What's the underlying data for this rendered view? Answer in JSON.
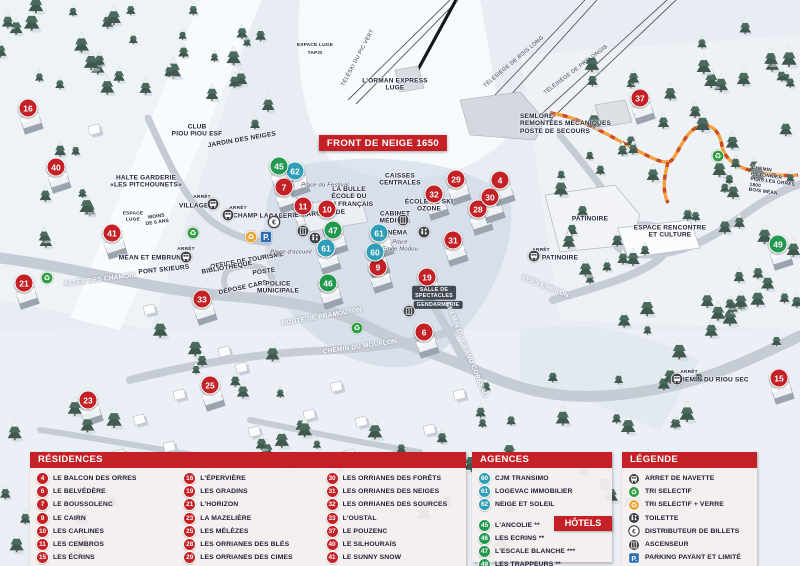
{
  "colors": {
    "red": "#c42126",
    "teal": "#2f9fb8",
    "green": "#23984f",
    "parking_blue": "#2a6db4",
    "legend_dark": "#3e4045",
    "recycle_green": "#2f9e41",
    "recycle_yellow": "#e9a63b",
    "panel_bg": "rgba(246,239,239,0.95)",
    "path_orange": "#f0a13f",
    "path_dash": "#cf4a24"
  },
  "map": {
    "banner": {
      "text": "FRONT DE NEIGE 1650",
      "x": 383,
      "y": 143
    },
    "markers": [
      {
        "n": "16",
        "t": "res",
        "x": 28,
        "y": 108
      },
      {
        "n": "40",
        "t": "res",
        "x": 56,
        "y": 167
      },
      {
        "n": "41",
        "t": "res",
        "x": 112,
        "y": 233
      },
      {
        "n": "21",
        "t": "res",
        "x": 24,
        "y": 283
      },
      {
        "n": "33",
        "t": "res",
        "x": 202,
        "y": 299
      },
      {
        "n": "23",
        "t": "res",
        "x": 88,
        "y": 400
      },
      {
        "n": "25",
        "t": "res",
        "x": 210,
        "y": 385
      },
      {
        "n": "7",
        "t": "res",
        "x": 284,
        "y": 187
      },
      {
        "n": "11",
        "t": "res",
        "x": 303,
        "y": 206
      },
      {
        "n": "10",
        "t": "res",
        "x": 327,
        "y": 209
      },
      {
        "n": "9",
        "t": "res",
        "x": 378,
        "y": 267
      },
      {
        "n": "6",
        "t": "res",
        "x": 424,
        "y": 332
      },
      {
        "n": "19",
        "t": "res",
        "x": 427,
        "y": 277
      },
      {
        "n": "29",
        "t": "res",
        "x": 456,
        "y": 179
      },
      {
        "n": "32",
        "t": "res",
        "x": 434,
        "y": 194
      },
      {
        "n": "28",
        "t": "res",
        "x": 478,
        "y": 209
      },
      {
        "n": "30",
        "t": "res",
        "x": 490,
        "y": 197
      },
      {
        "n": "4",
        "t": "res",
        "x": 500,
        "y": 180
      },
      {
        "n": "31",
        "t": "res",
        "x": 453,
        "y": 240
      },
      {
        "n": "37",
        "t": "res",
        "x": 640,
        "y": 98
      },
      {
        "n": "15",
        "t": "res",
        "x": 779,
        "y": 378
      },
      {
        "n": "60",
        "t": "agency",
        "x": 375,
        "y": 252
      },
      {
        "n": "61",
        "t": "agency",
        "x": 326,
        "y": 248
      },
      {
        "n": "61",
        "t": "agency",
        "x": 379,
        "y": 233
      },
      {
        "n": "62",
        "t": "agency",
        "x": 295,
        "y": 171
      },
      {
        "n": "45",
        "t": "hotel",
        "x": 279,
        "y": 166
      },
      {
        "n": "46",
        "t": "hotel",
        "x": 328,
        "y": 283
      },
      {
        "n": "47",
        "t": "hotel",
        "x": 333,
        "y": 230
      },
      {
        "n": "49",
        "t": "hotel",
        "x": 778,
        "y": 244
      }
    ],
    "icons": [
      {
        "k": "bus",
        "x": 213,
        "y": 204
      },
      {
        "k": "bus",
        "x": 228,
        "y": 215
      },
      {
        "k": "bus",
        "x": 186,
        "y": 257
      },
      {
        "k": "bus",
        "x": 534,
        "y": 256
      },
      {
        "k": "bus",
        "x": 677,
        "y": 379
      },
      {
        "k": "recycle",
        "x": 47,
        "y": 278
      },
      {
        "k": "recycle",
        "x": 193,
        "y": 233
      },
      {
        "k": "recycle",
        "x": 357,
        "y": 328
      },
      {
        "k": "recycle",
        "x": 718,
        "y": 156
      },
      {
        "k": "recycle-verre",
        "x": 251,
        "y": 237
      },
      {
        "k": "parking",
        "x": 266,
        "y": 237
      },
      {
        "k": "euro",
        "x": 274,
        "y": 222
      },
      {
        "k": "ascenseur",
        "x": 303,
        "y": 231
      },
      {
        "k": "ascenseur",
        "x": 403,
        "y": 220
      },
      {
        "k": "ascenseur",
        "x": 409,
        "y": 311
      },
      {
        "k": "toilette",
        "x": 315,
        "y": 238
      },
      {
        "k": "toilette",
        "x": 424,
        "y": 232
      }
    ],
    "labels": [
      {
        "text": "TÉLÉSKI DU PIC VERT",
        "x": 358,
        "y": 58,
        "s": "lift",
        "r": -62
      },
      {
        "text": "TÉLÉSIÈGE DE BOIS LONG",
        "x": 514,
        "y": 62,
        "s": "lift",
        "r": -40
      },
      {
        "text": "TÉLÉSIÈGE DE PRÉLONGIS",
        "x": 576,
        "y": 70,
        "s": "lift",
        "r": -37
      },
      {
        "text": "L'ORMAN EXPRESS\nLUGE",
        "x": 395,
        "y": 85,
        "s": "name"
      },
      {
        "text": "SEMLORE\nREMONTÉES MÉCANIQUES\nPOSTE DE SECOURS",
        "x": 520,
        "y": 124,
        "s": "name-left"
      },
      {
        "text": "ESPACE LUGE",
        "x": 315,
        "y": 46,
        "s": "tiny"
      },
      {
        "text": "TAPIS",
        "x": 315,
        "y": 54,
        "s": "tiny"
      },
      {
        "text": "CLUB\nPIOU PIOU ESF",
        "x": 197,
        "y": 131,
        "s": "name"
      },
      {
        "text": "JARDIN DES NEIGES",
        "x": 242,
        "y": 140,
        "s": "name",
        "r": -10
      },
      {
        "text": "HALTE GARDERIE\n«LES PITCHOUNETS»",
        "x": 146,
        "y": 182,
        "s": "name"
      },
      {
        "text": "ESPACE\nLUGE",
        "x": 133,
        "y": 217,
        "s": "tiny"
      },
      {
        "text": "MOINS\nDE 6 ANS",
        "x": 157,
        "y": 220,
        "s": "tiny",
        "r": -8
      },
      {
        "text": "ARRÊT",
        "x": 202,
        "y": 198,
        "s": "tiny"
      },
      {
        "text": "VILLAGES",
        "x": 196,
        "y": 206,
        "s": "name"
      },
      {
        "text": "ARRÊT",
        "x": 238,
        "y": 209,
        "s": "tiny"
      },
      {
        "text": "CHAMP LACAS",
        "x": 258,
        "y": 216,
        "s": "name"
      },
      {
        "text": "ARRÊT",
        "x": 186,
        "y": 250,
        "s": "tiny"
      },
      {
        "text": "MÉAN ET EMBRUN",
        "x": 150,
        "y": 258,
        "s": "name"
      },
      {
        "text": "PONT SKIEURS",
        "x": 164,
        "y": 270,
        "s": "name",
        "r": -6
      },
      {
        "text": "ALLÉE DES CHAMOIS",
        "x": 100,
        "y": 280,
        "s": "road",
        "r": -7
      },
      {
        "text": "GALERIE MARCHANDE",
        "x": 307,
        "y": 215,
        "s": "name",
        "r": -4
      },
      {
        "text": "LA BULLE\nÉCOLE DU\nSKI FRANÇAIS",
        "x": 349,
        "y": 197,
        "s": "name"
      },
      {
        "text": "Place du Festival",
        "x": 325,
        "y": 186,
        "s": "place"
      },
      {
        "text": "CAISSES\nCENTRALES",
        "x": 400,
        "y": 180,
        "s": "name"
      },
      {
        "text": "ÉCOLE DE SKI\nOZONE",
        "x": 429,
        "y": 206,
        "s": "name"
      },
      {
        "text": "CABINET\nMÉDICAL",
        "x": 395,
        "y": 218,
        "s": "name"
      },
      {
        "text": "CINÉMA",
        "x": 394,
        "y": 233,
        "s": "name"
      },
      {
        "text": "Place\nÉmile Modou",
        "x": 400,
        "y": 246,
        "s": "place"
      },
      {
        "text": "OFFICE DE TOURISME",
        "x": 247,
        "y": 261,
        "s": "name",
        "r": -10
      },
      {
        "text": "BIBLIOTHÈQUE",
        "x": 227,
        "y": 268,
        "s": "name",
        "r": -10
      },
      {
        "text": "POSTE",
        "x": 264,
        "y": 272,
        "s": "name",
        "r": -8
      },
      {
        "text": "DÉPOSE CARS",
        "x": 243,
        "y": 288,
        "s": "name",
        "r": -12
      },
      {
        "text": "POLICE\nMUNICIPALE",
        "x": 278,
        "y": 288,
        "s": "name"
      },
      {
        "text": "Place d'accueil",
        "x": 291,
        "y": 253,
        "s": "place"
      },
      {
        "text": "SALLE DE\nSPECTACLES",
        "x": 434,
        "y": 293,
        "s": "dark-box"
      },
      {
        "text": "GENDARMERIE",
        "x": 438,
        "y": 305,
        "s": "dark-box"
      },
      {
        "text": "ROUTE DE PRAMOUTON",
        "x": 322,
        "y": 317,
        "s": "road",
        "r": -10
      },
      {
        "text": "CHEMIN DU MOUFLON",
        "x": 360,
        "y": 347,
        "s": "road",
        "r": -8
      },
      {
        "text": "CHEMIN DU GRAND CORBEAU",
        "x": 466,
        "y": 350,
        "s": "road",
        "r": 68
      },
      {
        "text": "VERS EMBRUN",
        "x": 545,
        "y": 287,
        "s": "road",
        "r": 22
      },
      {
        "text": "PATINOIRE",
        "x": 590,
        "y": 219,
        "s": "name"
      },
      {
        "text": "ARRÊT",
        "x": 541,
        "y": 251,
        "s": "tiny"
      },
      {
        "text": "PATINOIRE",
        "x": 560,
        "y": 258,
        "s": "name"
      },
      {
        "text": "ESPACE RENCONTRE\nET CULTURE",
        "x": 670,
        "y": 232,
        "s": "name"
      },
      {
        "text": "CHEMIN PIÉTONNIER\nVERS LES ORRES 1800\nBOIS MÉAN",
        "x": 750,
        "y": 183,
        "s": "tiny-left",
        "r": 8
      },
      {
        "text": "ARRÊT",
        "x": 689,
        "y": 373,
        "s": "tiny"
      },
      {
        "text": "CHEMIN DU RIOU SEC",
        "x": 712,
        "y": 380,
        "s": "name"
      }
    ]
  },
  "panels": {
    "residences": {
      "title": "RÉSIDENCES",
      "columns": [
        [
          {
            "n": "4",
            "name": "LE BALCON DES ORRES"
          },
          {
            "n": "6",
            "name": "LE BELVÉDÈRE"
          },
          {
            "n": "7",
            "name": "LE BOUSSOLENC"
          },
          {
            "n": "9",
            "name": "LE CAIRN"
          },
          {
            "n": "10",
            "name": "LES CARLINES"
          },
          {
            "n": "11",
            "name": "LES CEMBROS"
          },
          {
            "n": "15",
            "name": "LES ÉCRINS"
          }
        ],
        [
          {
            "n": "16",
            "name": "L'ÉPERVIÈRE"
          },
          {
            "n": "19",
            "name": "LES GRADINS"
          },
          {
            "n": "21",
            "name": "L'HORIZON"
          },
          {
            "n": "23",
            "name": "LA MAZELIÈRE"
          },
          {
            "n": "25",
            "name": "LES MÉLÈZES"
          },
          {
            "n": "28",
            "name": "LES ORRIANES DES BLÉS"
          },
          {
            "n": "29",
            "name": "LES ORRIANES DES CIMES"
          }
        ],
        [
          {
            "n": "30",
            "name": "LES ORRIANES DES FORÊTS"
          },
          {
            "n": "31",
            "name": "LES ORRIANES DES NEIGES"
          },
          {
            "n": "32",
            "name": "LES ORRIANES DES SOURCES"
          },
          {
            "n": "33",
            "name": "L'OUSTAL"
          },
          {
            "n": "37",
            "name": "LE POUZENC"
          },
          {
            "n": "40",
            "name": "LE SILHOURAÏS"
          },
          {
            "n": "41",
            "name": "LE SUNNY SNOW"
          }
        ]
      ]
    },
    "agences": {
      "title": "AGENCES IMMOBILIÈRES",
      "items": [
        {
          "n": "60",
          "name": "CJM TRANSIMO"
        },
        {
          "n": "61",
          "name": "LOGEVAC IMMOBILIER"
        },
        {
          "n": "62",
          "name": "NEIGE ET SOLEIL"
        }
      ]
    },
    "hotels": {
      "title": "HÔTELS",
      "items": [
        {
          "n": "45",
          "name": "L'ANCOLIE **"
        },
        {
          "n": "46",
          "name": "LES ECRINS **"
        },
        {
          "n": "47",
          "name": "L'ESCALE BLANCHE ***"
        },
        {
          "n": "49",
          "name": "LES TRAPPEURS **"
        }
      ]
    },
    "legende": {
      "title": "LÉGENDE",
      "items": [
        {
          "icon": "bus",
          "label": "ARRET DE NAVETTE"
        },
        {
          "icon": "recycle",
          "label": "TRI SELECTIF"
        },
        {
          "icon": "recycle-verre",
          "label": "TRI SELECTIF + VERRE"
        },
        {
          "icon": "toilette",
          "label": "TOILETTE"
        },
        {
          "icon": "euro",
          "label": "DISTRIBUTEUR DE BILLETS"
        },
        {
          "icon": "ascenseur",
          "label": "ASCENSEUR"
        },
        {
          "icon": "parking",
          "label": "PARKING PAYANT ET LIMITÉ"
        }
      ]
    }
  }
}
